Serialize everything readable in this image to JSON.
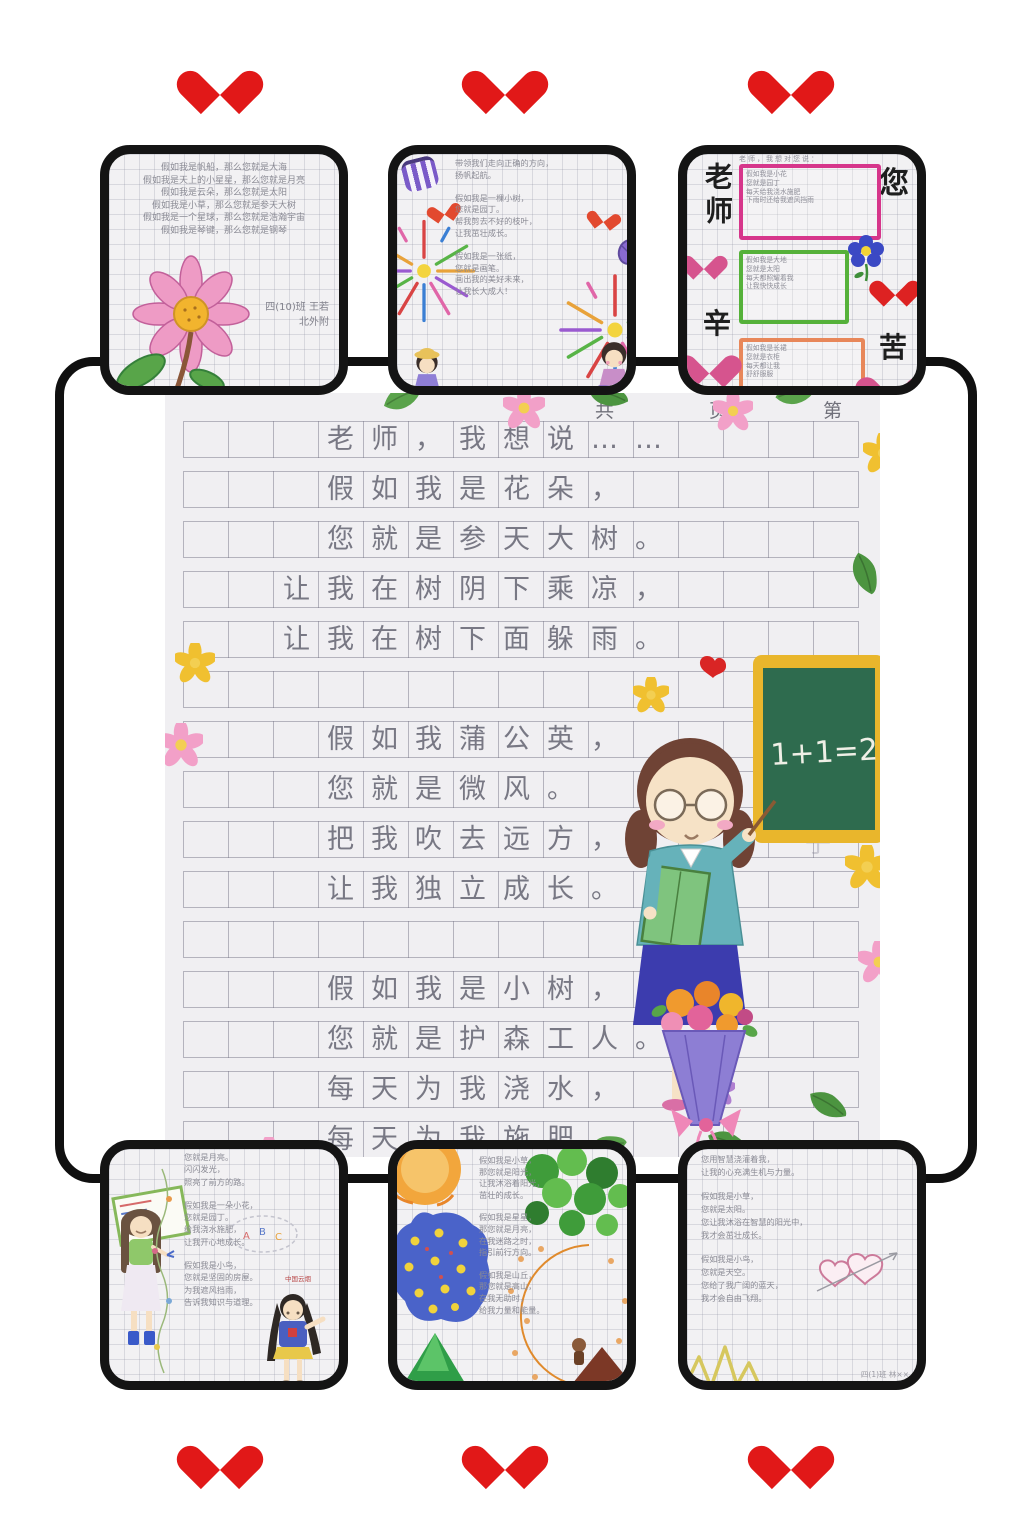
{
  "page": {
    "background": "#ffffff",
    "accent_red": "#e11818",
    "frame_color": "#101010",
    "paper_color": "#f0eff2",
    "pencil_color": "#787884"
  },
  "hearts": {
    "color": "#e11818",
    "top_count": 3,
    "bottom_count": 3
  },
  "main_sheet": {
    "header_text": "共　页　第　页",
    "poem_lines": [
      "老师，我想说……",
      "假如我是花朵，",
      "您就是参天大树。",
      "让我在树阴下乘凉，",
      "让我在树下面躲雨。",
      "假如我蒲公英，",
      "您就是微风。",
      "把我吹去远方，",
      "让我独立成长。",
      "假如我是小树，",
      "您就是护森工人。",
      "每天为我浇水，",
      "每天为我施肥。"
    ],
    "ghost_text": "子",
    "blackboard_text": "1+1=2",
    "illustrations": [
      "teacher-at-blackboard",
      "flower-bouquet",
      "sakura-flowers",
      "yellow-flowers",
      "green-leaves",
      "red-heart"
    ]
  },
  "cards": {
    "top_left": {
      "lines": [
        "假如我是帆船，那么您就是大海",
        "假如我是天上的小星星，那么您就是月亮",
        "假如我是云朵，那么您就是太阳",
        "假如我是小草，那么您就是参天大树",
        "假如我是一个星球，那么您就是浩瀚宇宙",
        "假如我是琴键，那么您就是钢琴"
      ],
      "signature_lines": [
        "四(10)班 王若",
        "北外附"
      ]
    },
    "top_middle": {
      "lines": [
        "带领我们走向正确的方向，",
        "扬帆起航。",
        "",
        "假如我是一棵小树，",
        "您就是园丁。",
        "帮我剪去不好的枝叶，",
        "让我茁壮成长。",
        "",
        "假如我是一张纸，",
        "您就是画笔。",
        "画出我的美好未来，",
        "让我长大成人！"
      ]
    },
    "top_right": {
      "heading": "老师，我想对您说：",
      "big_chars": {
        "top_left": "老师",
        "top_right": "您",
        "bottom_left": "辛",
        "bottom_right": "苦"
      },
      "boxes": [
        {
          "color": "#d6368b",
          "lines": [
            "假如我是小花",
            "您就是园丁",
            "每天给我浇水施肥",
            "下雨时还给我遮风挡雨"
          ]
        },
        {
          "color": "#55b13a",
          "lines": [
            "假如我是大地",
            "您就是太阳",
            "每天都照耀着我",
            "让我快快成长"
          ]
        },
        {
          "color": "#e8875a",
          "lines": [
            "假如我是长裙",
            "您就是衣柜",
            "每天都让我",
            "舒舒服服"
          ]
        }
      ]
    },
    "bottom_left": {
      "lines": [
        "您就是月亮。",
        "闪闪发光，",
        "照亮了前方的路。",
        "",
        "假如我是一朵小花，",
        "您就是园丁。",
        "给我浇水施肥，",
        "让我开心地成长。",
        "",
        "假如我是小鸟，",
        "您就是坚固的房屋。",
        "为我遮风挡雨，",
        "告诉我知识与道理。"
      ],
      "sticker_text": "中国云烟",
      "cloud_letters": "A B C"
    },
    "bottom_middle": {
      "lines": [
        "假如我是小草，",
        "那您就是阳光，",
        "让我沐浴着阳光，",
        "茁壮的成长。",
        "",
        "假如我是星星，",
        "那您就是月亮，",
        "在我迷路之时，",
        "指引前行方向。",
        "",
        "假如我是山丘，",
        "那您就是高山，",
        "在我无助时，",
        "给我力量和能量。"
      ]
    },
    "bottom_right": {
      "lines": [
        "您用智慧浇灌着我，",
        "让我的心充满生机与力量。",
        "",
        "假如我是小草，",
        "您就是太阳。",
        "您让我沐浴在智慧的阳光中，",
        "我才会茁壮成长。",
        "",
        "假如我是小鸟，",
        "您就是天空。",
        "您给了我广阔的蓝天，",
        "我才会自由飞翔。"
      ],
      "signature": "四(1)班 林××"
    }
  }
}
